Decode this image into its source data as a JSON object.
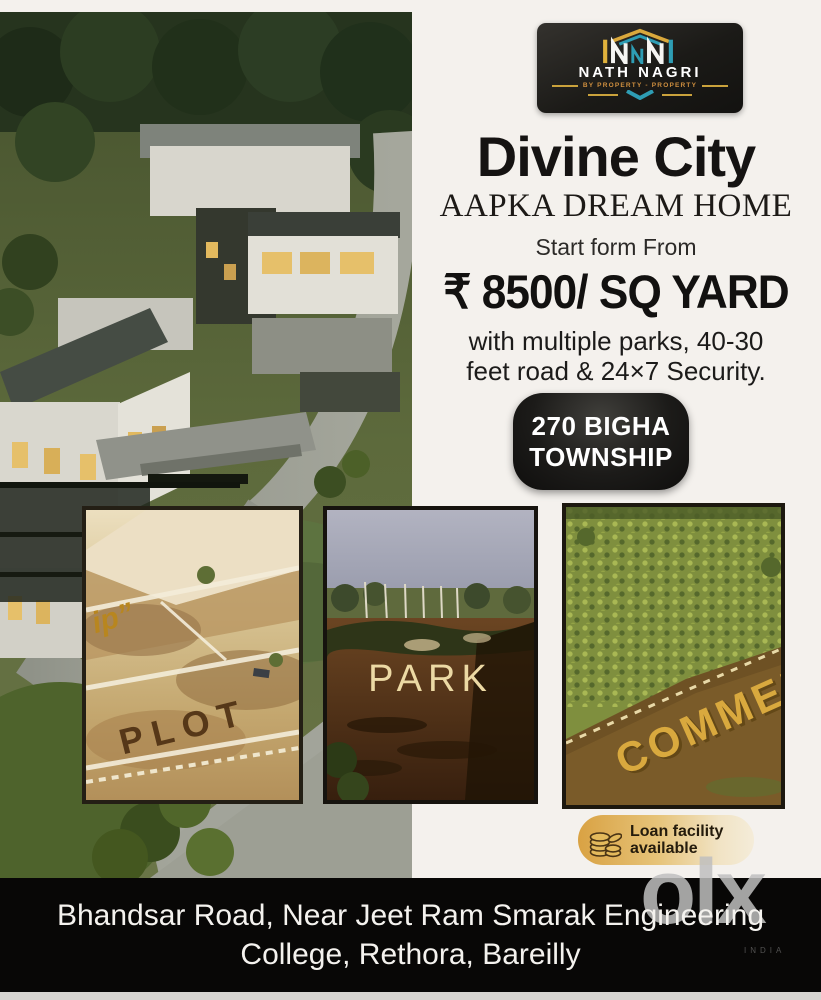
{
  "brand_card": {
    "name": "NATH NAGRI",
    "tagline": "BY PROPERTY - PROPERTY"
  },
  "hero": {
    "title": "Divine City",
    "subtitle": "AAPKA DREAM HOME",
    "start_label": "Start form From",
    "price": "₹ 8500/ SQ YARD",
    "features_line1": "with multiple parks, 40-30",
    "features_line2": "feet road & 24×7 Security.",
    "badge_line1": "270 BIGHA",
    "badge_line2": "TOWNSHIP"
  },
  "photos": {
    "plot": {
      "label": "PLOT",
      "corner_text": "ip”"
    },
    "park": {
      "label": "PARK"
    },
    "commercial": {
      "label": "COMMERCIAL"
    }
  },
  "loan_badge": {
    "line1": "Loan facility",
    "line2": "available"
  },
  "footer": {
    "address_line1": "Bhandsar Road, Near Jeet Ram Smarak Engineering",
    "address_line2": "College, Rethora, Bareilly"
  },
  "watermark": {
    "logo": "olx",
    "sub": "INDIA"
  },
  "colors": {
    "gold": "#D9A83C",
    "teal": "#2E9DB4",
    "panel_bg": "#F4F1ED",
    "badge_black": "#161614",
    "bar_black": "#080706",
    "pill_gold": "#D9A243",
    "olx_grey": "#BEBEBE"
  }
}
